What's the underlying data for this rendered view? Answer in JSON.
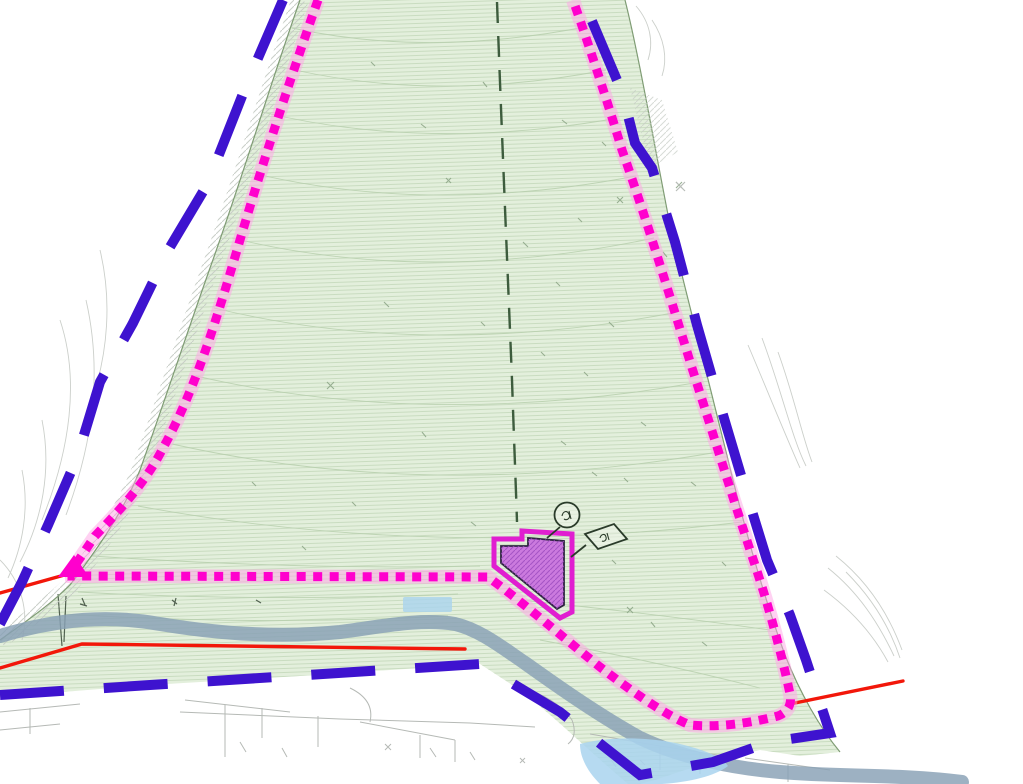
{
  "map": {
    "description": "Topographic site plan with planning boundaries, watercourse and building footprint",
    "colors": {
      "background": "#ffffff",
      "site_fill": "#e3efdc",
      "contour_line": "#bcd3b2",
      "site_edge": "#7f9c74",
      "outer_boundary": "#3e13cf",
      "inner_boundary": "#ff00cd",
      "inner_boundary_halo": "#ffa4e6",
      "red_line": "#f2170a",
      "watercourse": "#87a0b5",
      "water_fill": "#a9d3ee",
      "centerline": "#3d5c3d",
      "building_outline": "#e01ed0",
      "building_fill": "#cb7ade",
      "building_inner_line": "#2d2440",
      "survey_line": "#b2b6b2",
      "hatch_gray": "#c6ccc5",
      "marker_line": "#2a3b2a"
    },
    "features": {
      "outer_boundary": "blue-dashed-site-boundary",
      "inner_boundary": "magenta-dotted-inner-boundary",
      "centerline": "dark-dashed-centerline",
      "watercourse": "stream-corridor",
      "building": "building-footprint",
      "red_lines": "red-access-lines",
      "water_areas": "pond-and-water-feature",
      "terrain": "contoured-hillside"
    },
    "markers": [
      {
        "id": "circle-marker",
        "shape": "circle"
      },
      {
        "id": "diamond-marker",
        "shape": "diamond"
      }
    ]
  }
}
